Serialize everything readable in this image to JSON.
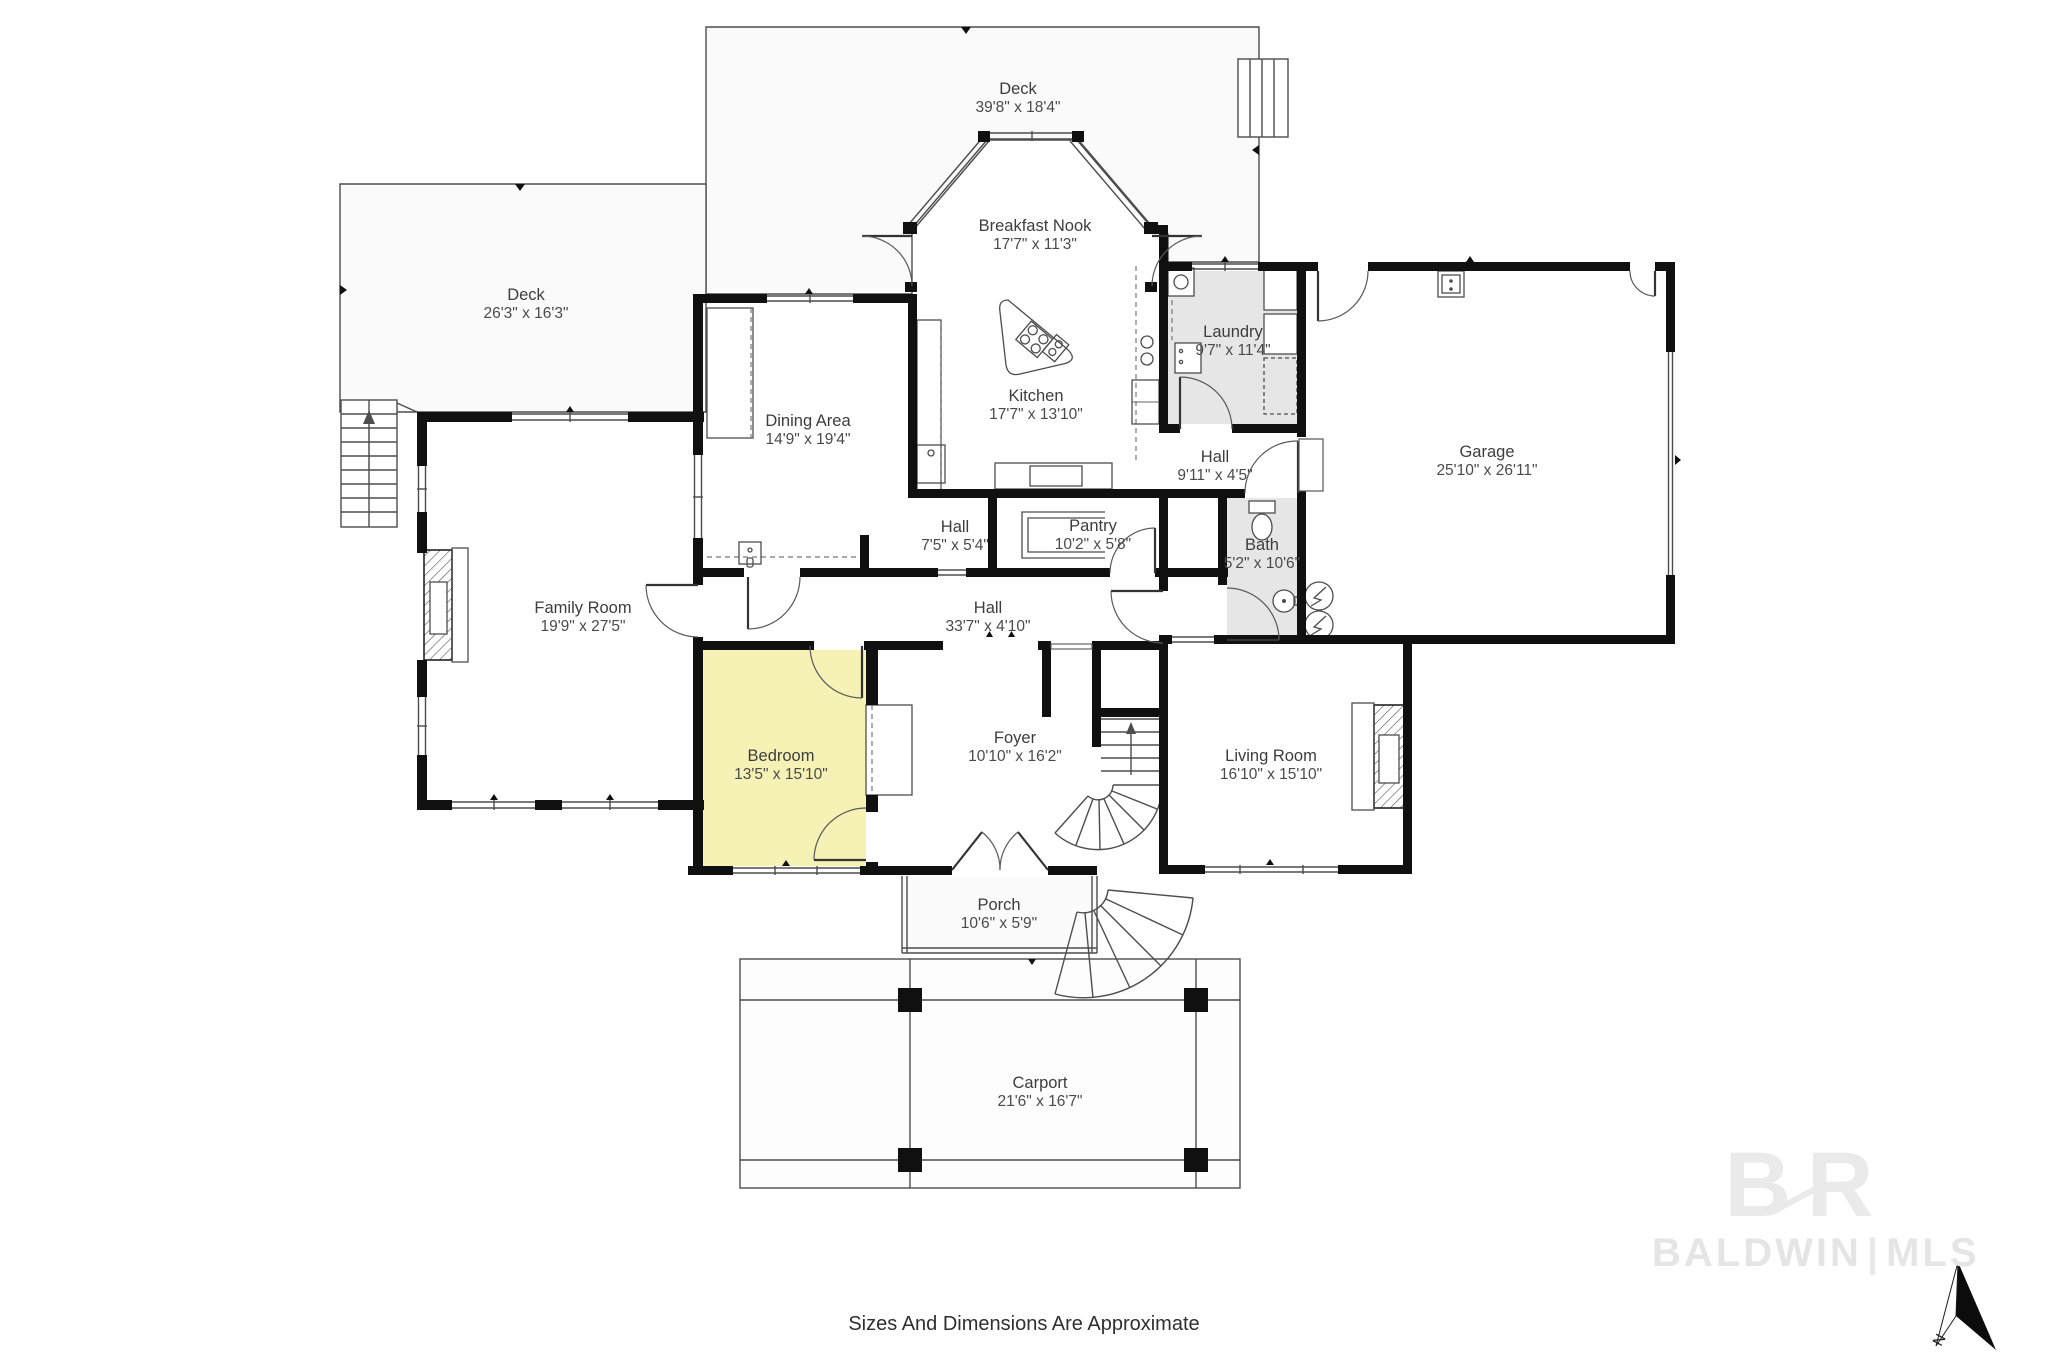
{
  "plan": {
    "rooms": [
      {
        "id": "deck-top",
        "name": "Deck",
        "dims": "39'8\" x 18'4\""
      },
      {
        "id": "breakfast-nook",
        "name": "Breakfast Nook",
        "dims": "17'7\" x 11'3\""
      },
      {
        "id": "deck-left",
        "name": "Deck",
        "dims": "26'3\" x 16'3\""
      },
      {
        "id": "dining-area",
        "name": "Dining Area",
        "dims": "14'9\" x 19'4\""
      },
      {
        "id": "kitchen",
        "name": "Kitchen",
        "dims": "17'7\" x 13'10\""
      },
      {
        "id": "laundry",
        "name": "Laundry",
        "dims": "9'7\" x 11'4\""
      },
      {
        "id": "garage",
        "name": "Garage",
        "dims": "25'10\" x 26'11\""
      },
      {
        "id": "hall-upper",
        "name": "Hall",
        "dims": "9'11\" x 4'5\""
      },
      {
        "id": "hall-small",
        "name": "Hall",
        "dims": "7'5\" x 5'4\""
      },
      {
        "id": "pantry",
        "name": "Pantry",
        "dims": "10'2\" x 5'8\""
      },
      {
        "id": "bath",
        "name": "Bath",
        "dims": "5'2\" x 10'6\""
      },
      {
        "id": "family-room",
        "name": "Family Room",
        "dims": "19'9\" x 27'5\""
      },
      {
        "id": "hall-long",
        "name": "Hall",
        "dims": "33'7\" x 4'10\""
      },
      {
        "id": "bedroom",
        "name": "Bedroom",
        "dims": "13'5\" x 15'10\""
      },
      {
        "id": "foyer",
        "name": "Foyer",
        "dims": "10'10\" x 16'2\""
      },
      {
        "id": "living-room",
        "name": "Living Room",
        "dims": "16'10\" x 15'10\""
      },
      {
        "id": "porch",
        "name": "Porch",
        "dims": "10'6\" x 5'9\""
      },
      {
        "id": "carport",
        "name": "Carport",
        "dims": "21'6\" x 16'7\""
      }
    ],
    "disclaimer": "Sizes And Dimensions Are Approximate",
    "compass": {
      "label": "N"
    },
    "watermark": {
      "monogram": "BR",
      "brand": "BALDWIN",
      "separator": "|",
      "suffix": "MLS"
    },
    "colors": {
      "wall": "#101010",
      "bedroom_highlight": "#f6f1b4",
      "wet_room_fill": "#e6e6e6",
      "deck_fill": "#fafafa",
      "watermark": "#eaeaea"
    }
  }
}
